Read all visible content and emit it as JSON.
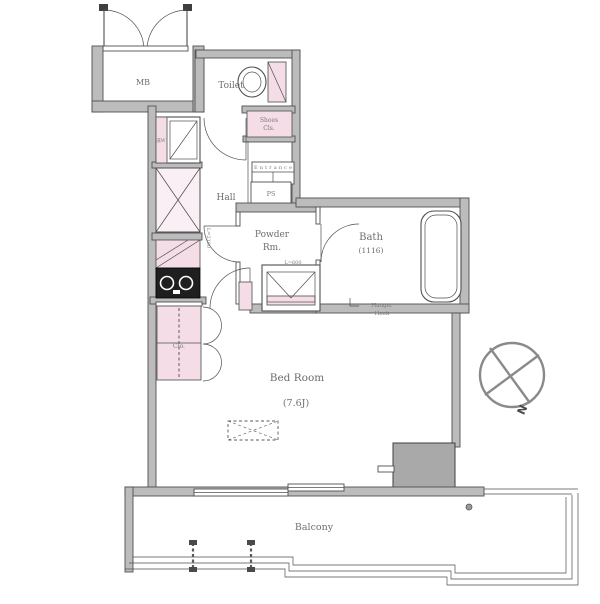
{
  "meta": {
    "type": "apartment-floor-plan"
  },
  "rooms": {
    "mb": "MB",
    "toilet": "Toilet",
    "hall": "Hall",
    "powder_line1": "Powder",
    "powder_line2": "Rm.",
    "bath": "Bath",
    "bath_size": "(1116)",
    "bedroom": "Bed Room",
    "bedroom_size": "(7.6J)",
    "balcony": "Balcony"
  },
  "fixtures": {
    "shoes_closet_line1": "Shoes",
    "shoes_closet_line2": "Cls.",
    "pipe_shaft": "PS",
    "closet": "Clo.",
    "entrance": "Entrance",
    "washer": "洗W",
    "kitchen_length": "L=2100",
    "vanity_length": "L=600",
    "hanger_hook_line1": "Hanger",
    "hanger_hook_line2": "Hook"
  },
  "compass": {
    "north": "N"
  },
  "colors": {
    "wall_fill": "#bcbcbc",
    "line": "#4f4f4f",
    "fixture_pink": "#f4dde6",
    "label_text": "#6e6e6e",
    "stove": "#1f1f1f",
    "background": "#ffffff"
  }
}
